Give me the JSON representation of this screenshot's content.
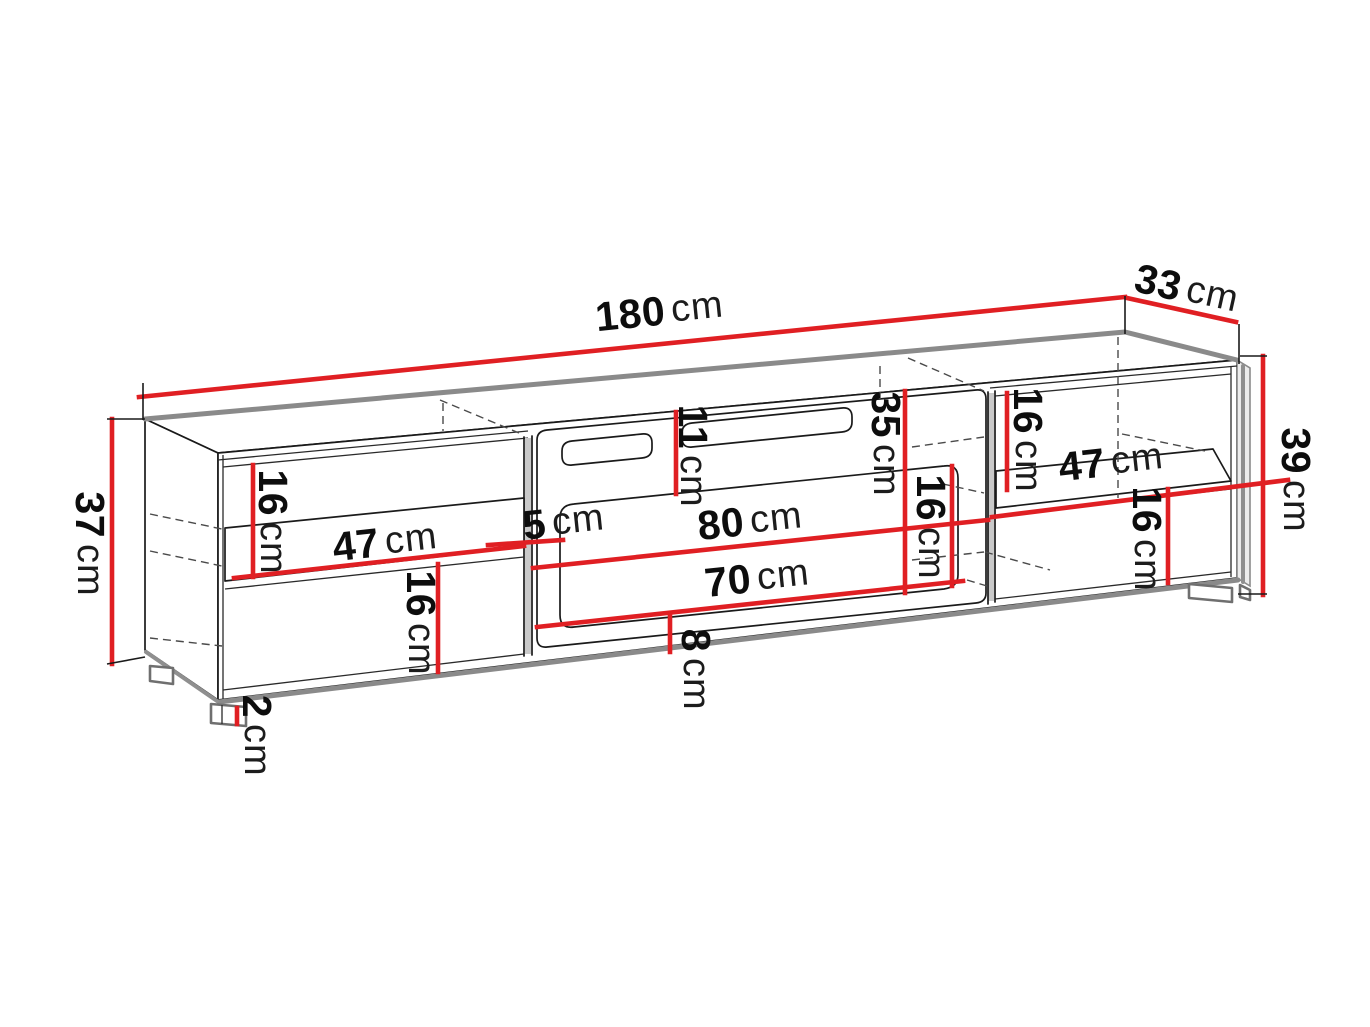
{
  "diagram": {
    "kind": "furniture dimension drawing",
    "unit": "cm"
  },
  "colors": {
    "dimension_line": "#e01f23",
    "outline": "#1a1a1a",
    "shaded_edge": "#8a8a8a",
    "hidden_edge": "#4a4a4a",
    "background": "#ffffff"
  },
  "labels": {
    "width_total": {
      "num": "180",
      "unit": "cm"
    },
    "depth_total": {
      "num": "33",
      "unit": "cm"
    },
    "height_left": {
      "num": "37",
      "unit": "cm"
    },
    "height_right": {
      "num": "39",
      "unit": "cm"
    },
    "left_top_clearance": {
      "num": "16",
      "unit": "cm"
    },
    "left_shelf_width": {
      "num": "47",
      "unit": "cm"
    },
    "groove_side_offset": {
      "num": "5",
      "unit": "cm"
    },
    "left_bottom_clearance": {
      "num": "16",
      "unit": "cm"
    },
    "foot_height": {
      "num": "2",
      "unit": "cm"
    },
    "slot_top_offset": {
      "num": "11",
      "unit": "cm"
    },
    "door_width": {
      "num": "80",
      "unit": "cm"
    },
    "groove_width": {
      "num": "70",
      "unit": "cm"
    },
    "groove_bottom_offset": {
      "num": "8",
      "unit": "cm"
    },
    "door_height": {
      "num": "35",
      "unit": "cm"
    },
    "mid_clearance": {
      "num": "16",
      "unit": "cm"
    },
    "right_top_clearance": {
      "num": "16",
      "unit": "cm"
    },
    "right_shelf_width": {
      "num": "47",
      "unit": "cm"
    },
    "right_bottom_clearance": {
      "num": "16",
      "unit": "cm"
    }
  }
}
